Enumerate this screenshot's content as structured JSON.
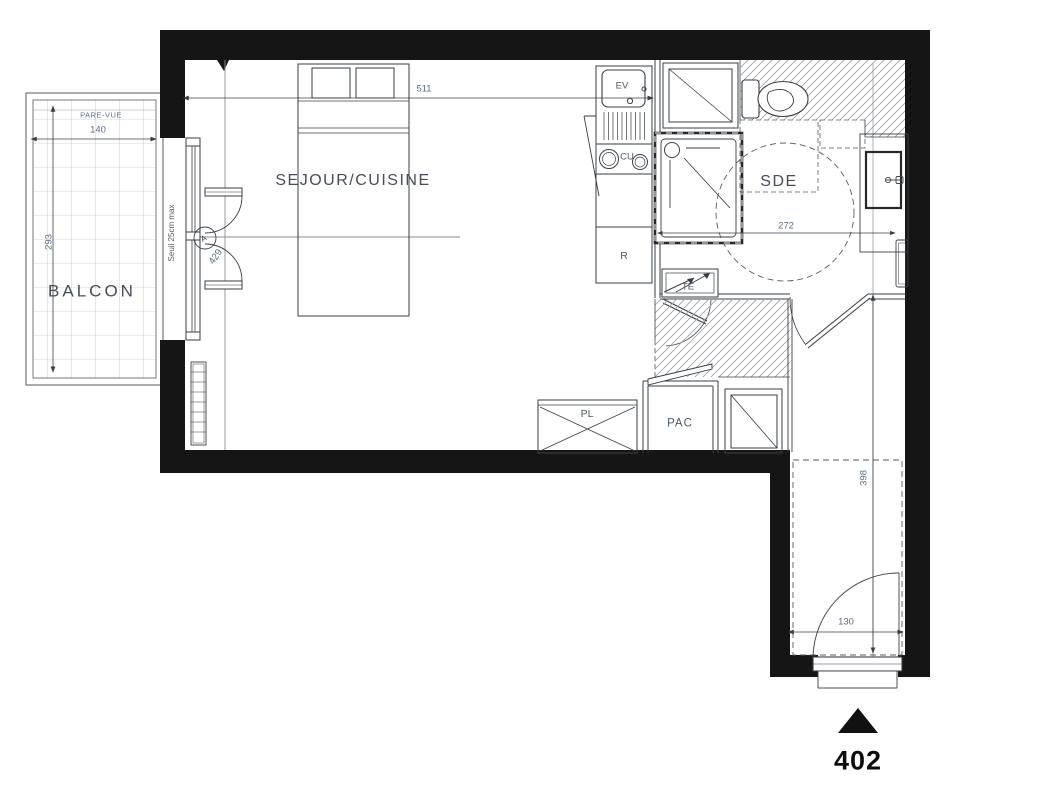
{
  "unit": {
    "number": "402"
  },
  "balcony": {
    "label": "BALCON",
    "screen_label": "PARE-VUE",
    "width_dim": "140",
    "depth_dim": "293"
  },
  "window": {
    "threshold_note": "Seuil 25cm max",
    "marker": "A",
    "door_dim": "429"
  },
  "living": {
    "label": "SEJOUR/CUISINE",
    "width_dim": "511"
  },
  "kitchen": {
    "sink_label": "EV",
    "hob_label": "CU",
    "fridge_label": "R"
  },
  "bathroom": {
    "label": "SDE",
    "width_dim": "272"
  },
  "utility": {
    "electrical_label": "TE",
    "closet_label": "PL",
    "heatpump_label": "PAC"
  },
  "hall": {
    "length_dim": "398",
    "door_dim": "130"
  },
  "colors": {
    "wall": "#151515",
    "line": "#3a3f44",
    "reference_line": "#8a8f94",
    "hatch": "#9aa0a6",
    "dim_text": "#5c6e84",
    "label_text": "#474d58"
  }
}
